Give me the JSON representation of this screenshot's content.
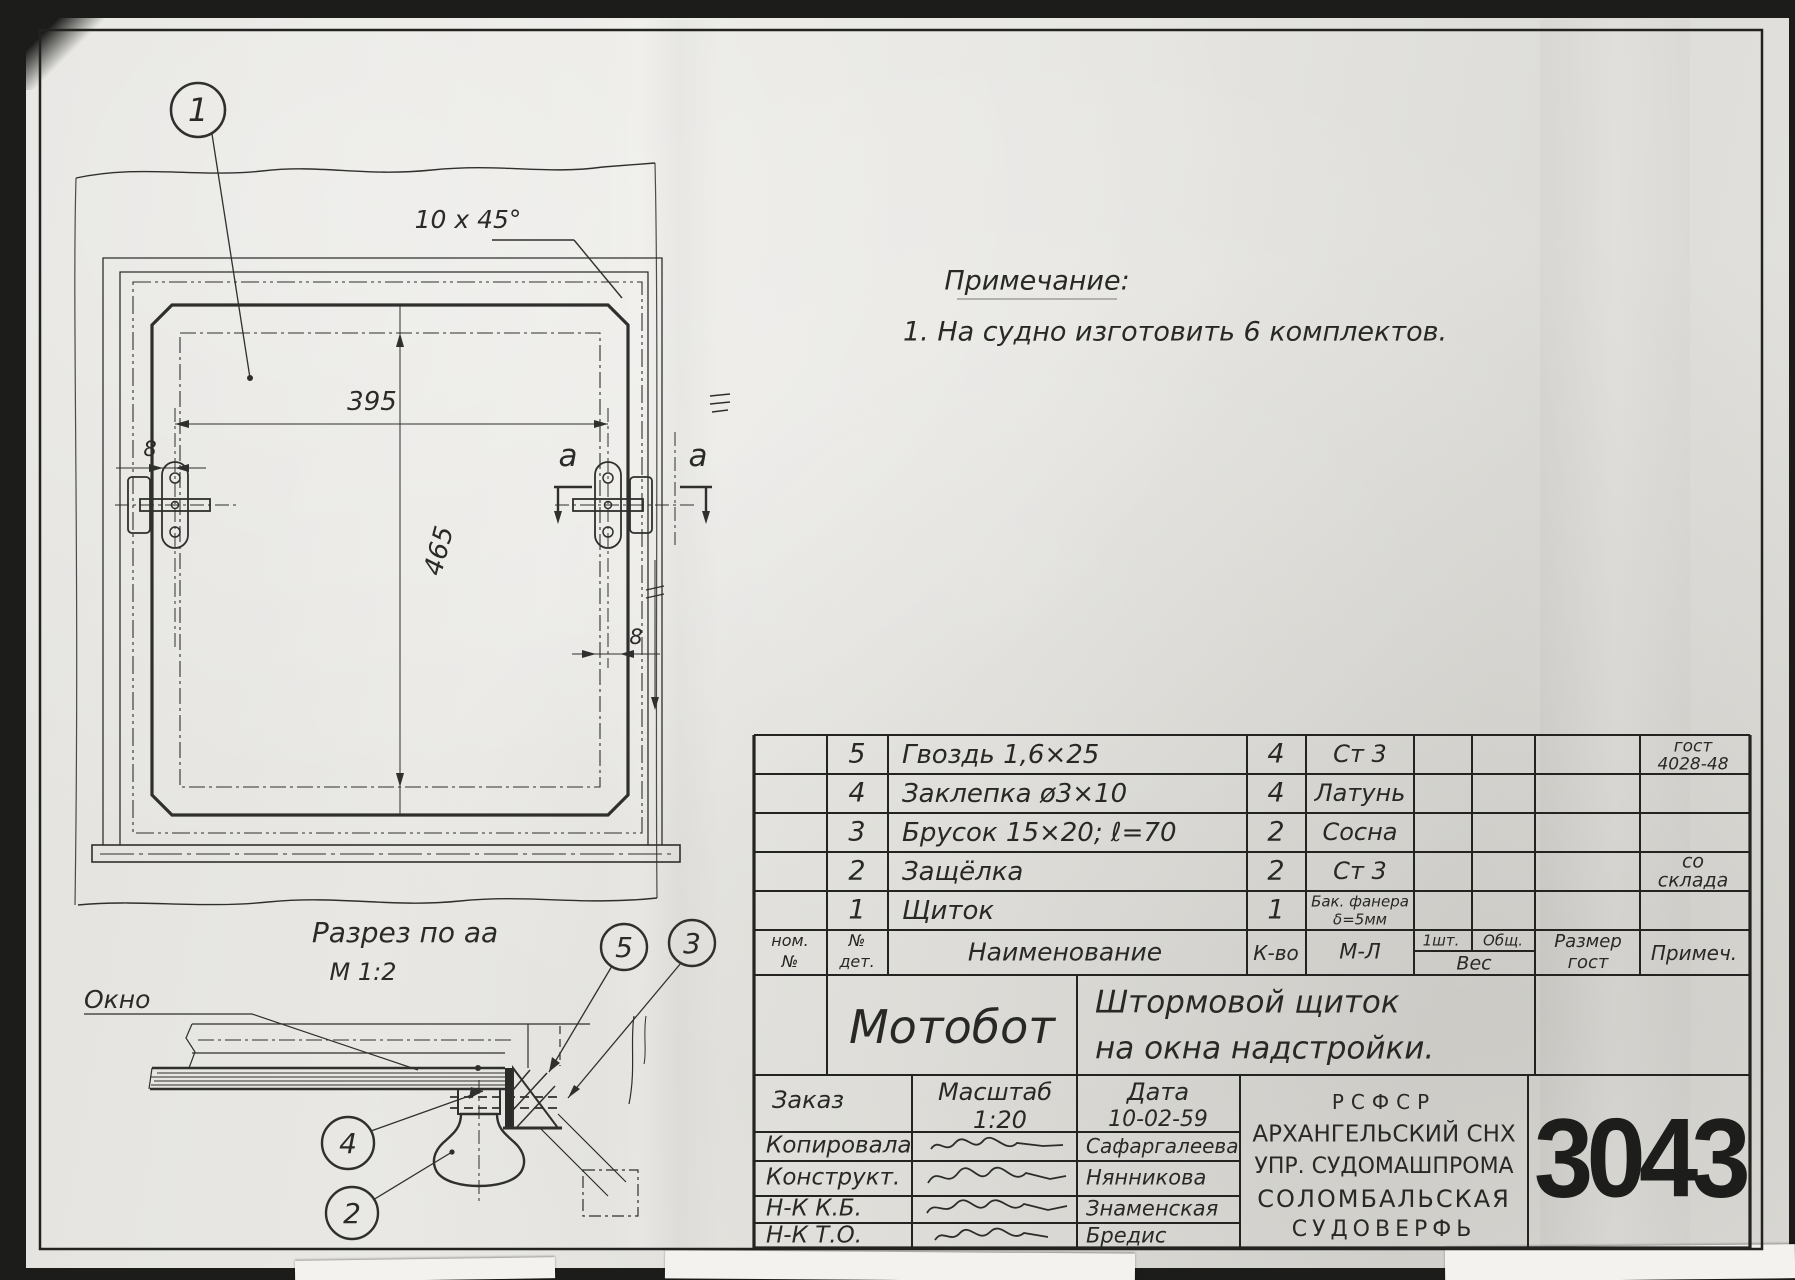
{
  "sheet": {
    "note": {
      "title": "Примечание:",
      "line1": "1. На судно изготовить 6 комплектов."
    },
    "main_view": {
      "balloon1": "1",
      "chamfer_callout": "10 х 45°",
      "dim_width": "395",
      "dim_height": "465",
      "dim_offset_left": "8",
      "dim_offset_right": "8",
      "section_letter_left": "а",
      "section_letter_right": "а"
    },
    "section_view": {
      "title": "Разрез по аа",
      "scale": "М 1:2",
      "window_label": "Окно",
      "balloon5": "5",
      "balloon3": "3",
      "balloon4": "4",
      "balloon2": "2"
    },
    "bom": {
      "headers": {
        "nom1": "ном.",
        "nom2": "№",
        "det1": "№",
        "det2": "дет.",
        "name": "Наименование",
        "qty": "К-во",
        "mat": "М-Л",
        "one": "1шт.",
        "total": "Общ.",
        "weight": "Вес",
        "size1": "Размер",
        "size2": "гост",
        "note": "Примеч."
      },
      "rows": [
        {
          "det": "5",
          "name": "Гвоздь 1,6×25",
          "qty": "4",
          "mat": "Ст 3",
          "mat2": "",
          "note1": "гост",
          "note2": "4028-48"
        },
        {
          "det": "4",
          "name": "Заклепка ø3×10",
          "qty": "4",
          "mat": "Латунь",
          "mat2": "",
          "note1": "",
          "note2": ""
        },
        {
          "det": "3",
          "name": "Брусок 15×20; ℓ=70",
          "qty": "2",
          "mat": "Сосна",
          "mat2": "",
          "note1": "",
          "note2": ""
        },
        {
          "det": "2",
          "name": "Защёлка",
          "qty": "2",
          "mat": "Ст 3",
          "mat2": "",
          "note1": "со",
          "note2": "склада"
        },
        {
          "det": "1",
          "name": "Щиток",
          "qty": "1",
          "mat": "Бак. фанера",
          "mat2": "δ=5мм",
          "note1": "",
          "note2": ""
        }
      ]
    },
    "title_block": {
      "object": "Мотобот",
      "title_line1": "Штормовой щиток",
      "title_line2": "на окна надстройки.",
      "order_label": "Заказ",
      "scale_label": "Масштаб",
      "scale_value": "1:20",
      "date_label": "Дата",
      "date_value": "10-02-59",
      "sign_rows": [
        {
          "role": "Копировала",
          "name": "Сафаргалеева"
        },
        {
          "role": "Конструкт.",
          "name": "Нянникова"
        },
        {
          "role": "Н-К К.Б.",
          "name": "Знаменская"
        },
        {
          "role": "Н-К Т.О.",
          "name": "Бредис"
        }
      ],
      "org_line1": "РСФСР",
      "org_line2": "АРХАНГЕЛЬСКИЙ СНХ",
      "org_line3": "УПР. СУДОМАШПРОМА",
      "org_line4": "СОЛОМБАЛЬСКАЯ",
      "org_line5": "СУДОВЕРФЬ",
      "drawing_number": "3043"
    }
  }
}
